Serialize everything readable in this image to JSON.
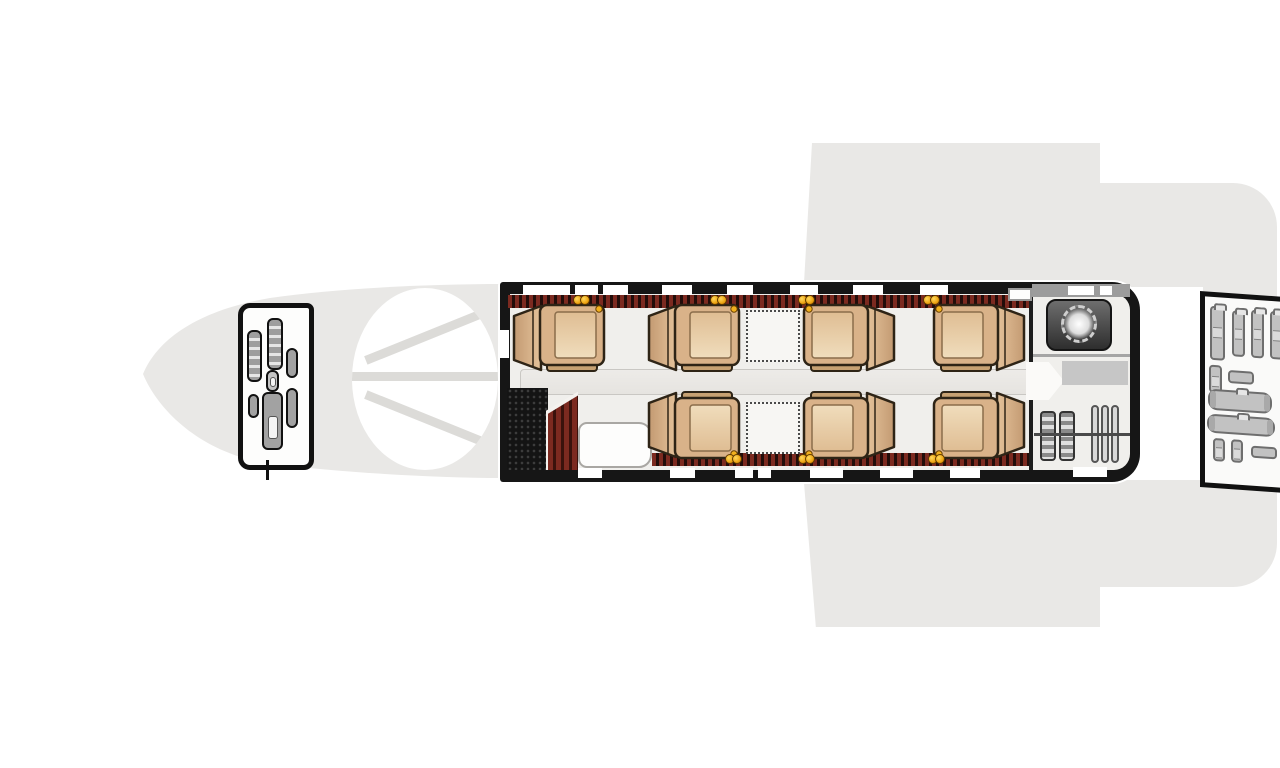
{
  "diagram": {
    "type": "aircraft-cabin-floor-plan",
    "view": "top-down",
    "aircraft_kind": "business-jet",
    "nose_direction": "left",
    "passenger_seat_count": 7,
    "crew_seat_count": 2,
    "club_table_count": 2,
    "zones": [
      "cockpit",
      "windshield",
      "entry-door-stair",
      "forward-galley",
      "club-seating",
      "aisle",
      "lavatory",
      "wardrobe",
      "aft-baggage-compartment",
      "wings",
      "tail"
    ]
  },
  "colors": {
    "fuselage_gray": "#e9e8e6",
    "cabin_wall": "#161616",
    "stripe_red": "#7c2a20",
    "stripe_dark": "#220d0a",
    "seat_tan": "#d9b289",
    "seat_tan_light": "#f0ddbc",
    "seat_outline": "#2e2416",
    "seat_footer": "#c7a172",
    "accent_yellow": "#f2b01e",
    "floor": "#f0efec",
    "luggage_gray": "#c2c2c2",
    "toilet_dark": "#3c3c3c",
    "lav_band_gray": "#9c9c9c"
  },
  "seats": [
    {
      "id": "seat-1",
      "row": "upper",
      "x": 511,
      "y": 303,
      "facing": "aft"
    },
    {
      "id": "seat-2",
      "row": "upper",
      "x": 646,
      "y": 303,
      "facing": "aft"
    },
    {
      "id": "seat-3",
      "row": "upper",
      "x": 801,
      "y": 303,
      "facing": "forward"
    },
    {
      "id": "seat-4",
      "row": "upper",
      "x": 931,
      "y": 303,
      "facing": "forward"
    },
    {
      "id": "seat-5",
      "row": "lower",
      "x": 646,
      "y": 390,
      "facing": "aft"
    },
    {
      "id": "seat-6",
      "row": "lower",
      "x": 801,
      "y": 390,
      "facing": "forward"
    },
    {
      "id": "seat-7",
      "row": "lower",
      "x": 931,
      "y": 390,
      "facing": "forward"
    }
  ],
  "tables": [
    {
      "id": "table-upper",
      "x": 746,
      "y": 310
    },
    {
      "id": "table-lower",
      "x": 746,
      "y": 402
    }
  ],
  "windows": {
    "top": [
      {
        "x": 523,
        "w": 47
      },
      {
        "x": 575,
        "w": 23
      },
      {
        "x": 603,
        "w": 25
      },
      {
        "x": 662,
        "w": 30
      },
      {
        "x": 727,
        "w": 26
      },
      {
        "x": 790,
        "w": 28
      },
      {
        "x": 853,
        "w": 30
      },
      {
        "x": 920,
        "w": 28
      }
    ],
    "bottom": [
      {
        "x": 578,
        "w": 24
      },
      {
        "x": 670,
        "w": 25
      },
      {
        "x": 735,
        "w": 18
      },
      {
        "x": 758,
        "w": 13
      },
      {
        "x": 810,
        "w": 33
      },
      {
        "x": 880,
        "w": 33
      },
      {
        "x": 950,
        "w": 30
      }
    ],
    "lav_top": [
      {
        "x": 1068,
        "w": 26
      },
      {
        "x": 1100,
        "w": 12
      }
    ],
    "lav_bottom": [
      {
        "x": 1073,
        "w": 34
      }
    ]
  },
  "accent_lights": {
    "top_centers": [
      585,
      722,
      810,
      935
    ],
    "bottom_centers": [
      737,
      810,
      940
    ]
  },
  "cockpit_items": [
    {
      "kind": "seat",
      "x": 4,
      "y": 22,
      "w": 15,
      "h": 52
    },
    {
      "kind": "seat",
      "x": 24,
      "y": 10,
      "w": 16,
      "h": 52
    },
    {
      "kind": "box",
      "x": 43,
      "y": 40,
      "w": 12,
      "h": 30
    },
    {
      "kind": "ped",
      "x": 23,
      "y": 62,
      "w": 13,
      "h": 22
    },
    {
      "kind": "box",
      "x": 5,
      "y": 86,
      "w": 11,
      "h": 24
    },
    {
      "kind": "seat2",
      "x": 19,
      "y": 84,
      "w": 21,
      "h": 58
    },
    {
      "kind": "box",
      "x": 43,
      "y": 80,
      "w": 12,
      "h": 40
    }
  ],
  "luggage": [
    {
      "t": "v",
      "x": 5,
      "y": 9,
      "w": 15,
      "h": 54
    },
    {
      "t": "v",
      "x": 27,
      "y": 12,
      "w": 13,
      "h": 46
    },
    {
      "t": "v",
      "x": 46,
      "y": 10,
      "w": 13,
      "h": 48
    },
    {
      "t": "v",
      "x": 65,
      "y": 10,
      "w": 13,
      "h": 48
    },
    {
      "t": "s",
      "x": 4,
      "y": 68,
      "w": 13,
      "h": 28
    },
    {
      "t": "h",
      "x": 23,
      "y": 72,
      "w": 26,
      "h": 13
    },
    {
      "t": "d",
      "x": 3,
      "y": 92,
      "w": 64,
      "h": 21
    },
    {
      "t": "d",
      "x": 2,
      "y": 117,
      "w": 68,
      "h": 19
    },
    {
      "t": "s",
      "x": 8,
      "y": 141,
      "w": 12,
      "h": 23
    },
    {
      "t": "s",
      "x": 26,
      "y": 141,
      "w": 12,
      "h": 23
    },
    {
      "t": "h",
      "x": 46,
      "y": 146,
      "w": 26,
      "h": 12
    }
  ],
  "wardrobe": {
    "garment_stacks": 2,
    "hangers": 3
  }
}
